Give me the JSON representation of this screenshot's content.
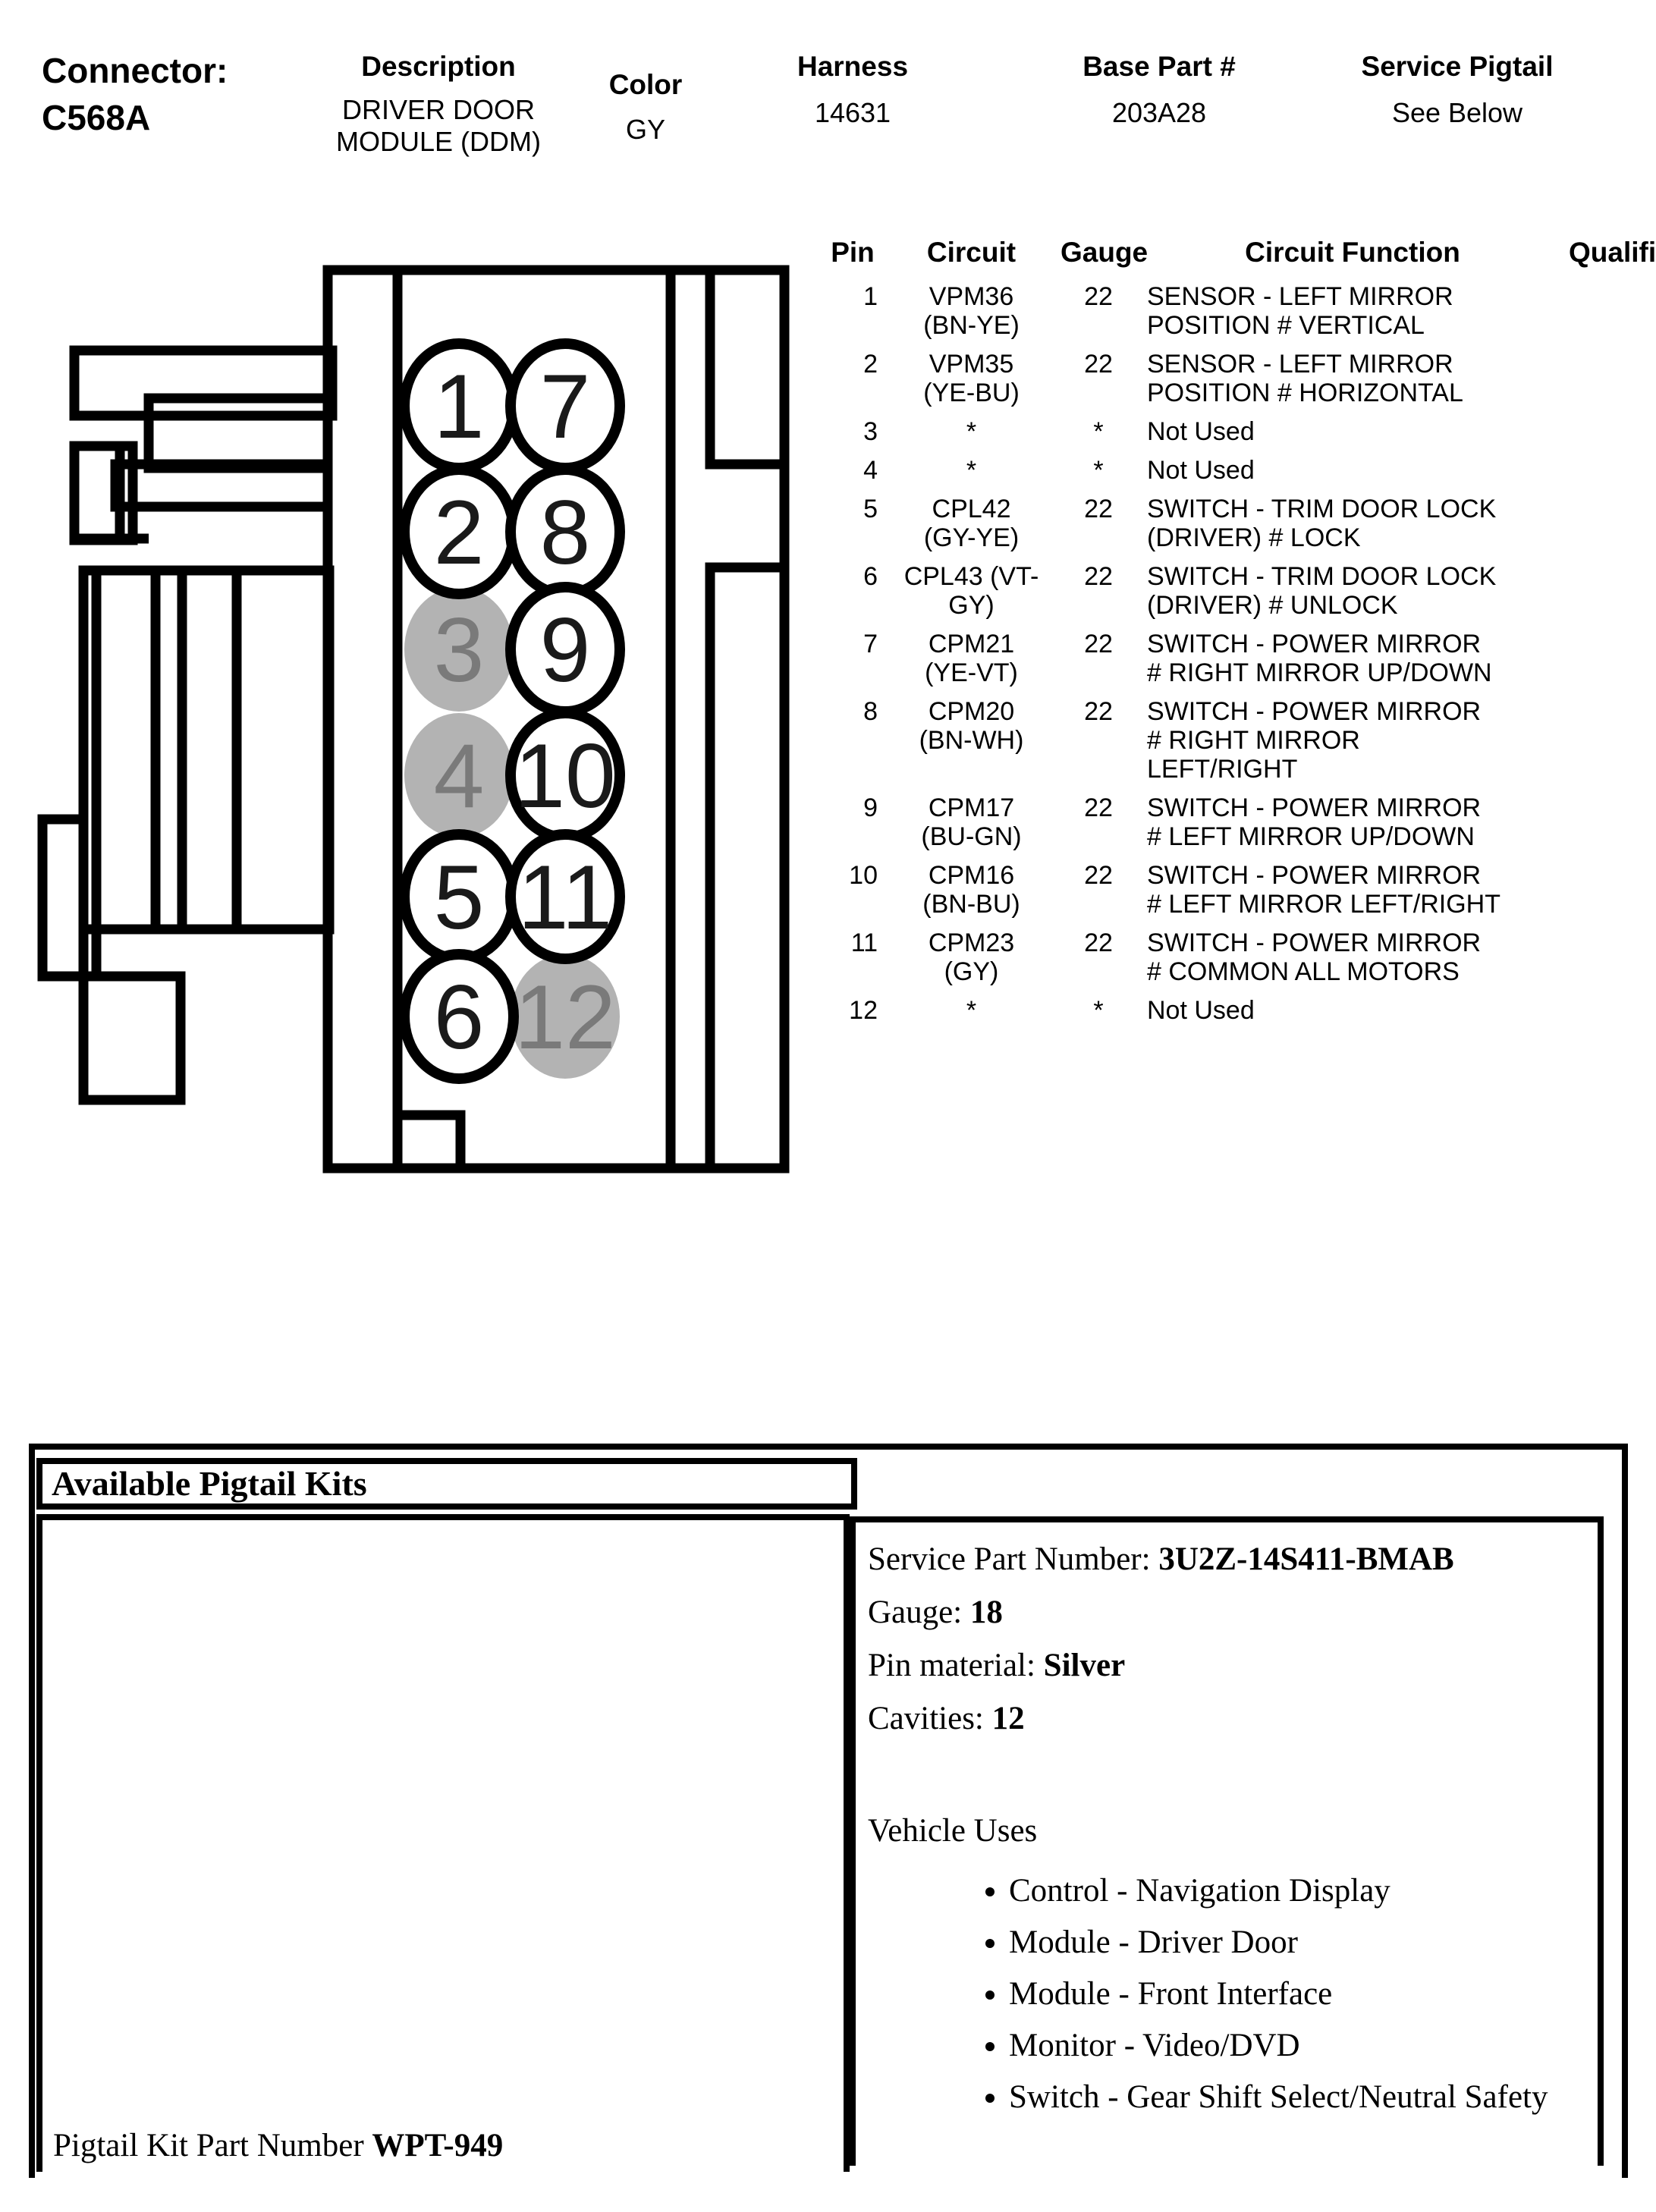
{
  "header": {
    "connector_label": "Connector:",
    "connector_id": "C568A",
    "columns": [
      {
        "label": "Description",
        "value_lines": [
          "DRIVER DOOR",
          "MODULE (DDM)"
        ]
      },
      {
        "label": "Color",
        "value_lines": [
          "GY"
        ]
      },
      {
        "label": "Harness",
        "value_lines": [
          "14631"
        ]
      },
      {
        "label": "Base Part #",
        "value_lines": [
          "203A28"
        ]
      },
      {
        "label": "Service Pigtail",
        "value_lines": [
          "See Below"
        ]
      }
    ]
  },
  "pin_table": {
    "headers": [
      "Pin",
      "Circuit",
      "Gauge",
      "Circuit Function",
      "Qualifier"
    ],
    "rows": [
      {
        "pin": "1",
        "circuit": [
          "VPM36",
          "(BN-YE)"
        ],
        "gauge": "22",
        "function": [
          "SENSOR - LEFT MIRROR",
          "POSITION # VERTICAL"
        ],
        "qualifier": ""
      },
      {
        "pin": "2",
        "circuit": [
          "VPM35",
          "(YE-BU)"
        ],
        "gauge": "22",
        "function": [
          "SENSOR - LEFT MIRROR",
          "POSITION # HORIZONTAL"
        ],
        "qualifier": ""
      },
      {
        "pin": "3",
        "circuit": [
          "*"
        ],
        "gauge": "*",
        "function": [
          "Not Used"
        ],
        "qualifier": ""
      },
      {
        "pin": "4",
        "circuit": [
          "*"
        ],
        "gauge": "*",
        "function": [
          "Not Used"
        ],
        "qualifier": ""
      },
      {
        "pin": "5",
        "circuit": [
          "CPL42",
          "(GY-YE)"
        ],
        "gauge": "22",
        "function": [
          "SWITCH - TRIM DOOR LOCK",
          "(DRIVER) # LOCK"
        ],
        "qualifier": ""
      },
      {
        "pin": "6",
        "circuit": [
          "CPL43 (VT-",
          "GY)"
        ],
        "gauge": "22",
        "function": [
          "SWITCH - TRIM DOOR LOCK",
          "(DRIVER) # UNLOCK"
        ],
        "qualifier": ""
      },
      {
        "pin": "7",
        "circuit": [
          "CPM21",
          "(YE-VT)"
        ],
        "gauge": "22",
        "function": [
          "SWITCH - POWER MIRROR",
          "# RIGHT MIRROR UP/DOWN"
        ],
        "qualifier": ""
      },
      {
        "pin": "8",
        "circuit": [
          "CPM20",
          "(BN-WH)"
        ],
        "gauge": "22",
        "function": [
          "SWITCH - POWER MIRROR",
          "# RIGHT MIRROR",
          "LEFT/RIGHT"
        ],
        "qualifier": ""
      },
      {
        "pin": "9",
        "circuit": [
          "CPM17",
          "(BU-GN)"
        ],
        "gauge": "22",
        "function": [
          "SWITCH - POWER MIRROR",
          "# LEFT MIRROR UP/DOWN"
        ],
        "qualifier": ""
      },
      {
        "pin": "10",
        "circuit": [
          "CPM16",
          "(BN-BU)"
        ],
        "gauge": "22",
        "function": [
          "SWITCH - POWER MIRROR",
          "# LEFT MIRROR LEFT/RIGHT"
        ],
        "qualifier": ""
      },
      {
        "pin": "11",
        "circuit": [
          "CPM23",
          "(GY)"
        ],
        "gauge": "22",
        "function": [
          "SWITCH - POWER MIRROR",
          "# COMMON ALL MOTORS"
        ],
        "qualifier": ""
      },
      {
        "pin": "12",
        "circuit": [
          "*"
        ],
        "gauge": "*",
        "function": [
          "Not Used"
        ],
        "qualifier": ""
      }
    ]
  },
  "connector_diagram": {
    "pins": [
      {
        "number": "1",
        "used": true
      },
      {
        "number": "2",
        "used": true
      },
      {
        "number": "3",
        "used": false
      },
      {
        "number": "4",
        "used": false
      },
      {
        "number": "5",
        "used": true
      },
      {
        "number": "6",
        "used": true
      },
      {
        "number": "7",
        "used": true
      },
      {
        "number": "8",
        "used": true
      },
      {
        "number": "9",
        "used": true
      },
      {
        "number": "10",
        "used": true
      },
      {
        "number": "11",
        "used": true
      },
      {
        "number": "12",
        "used": false
      }
    ]
  },
  "pigtail": {
    "title": "Available Pigtail Kits",
    "kit_label": "Pigtail Kit Part Number ",
    "kit_value": "WPT-949",
    "service": [
      {
        "label": "Service Part Number: ",
        "value": "3U2Z-14S411-BMAB"
      },
      {
        "label": "Gauge: ",
        "value": "18"
      },
      {
        "label": "Pin material: ",
        "value": "Silver"
      },
      {
        "label": "Cavities: ",
        "value": "12"
      }
    ],
    "vehicle_uses_title": "Vehicle Uses",
    "vehicle_uses": [
      "Control - Navigation Display",
      "Module - Driver Door",
      "Module - Front Interface",
      "Monitor - Video/DVD",
      "Switch - Gear Shift Select/Neutral Safety"
    ]
  },
  "colors": {
    "line": "#000000",
    "unused_pin_fill": "#B3B3B3",
    "unused_pin_text": "#7A7A7A",
    "used_pin_fill": "#FFFFFF",
    "pin_text": "#1A1A1A"
  }
}
